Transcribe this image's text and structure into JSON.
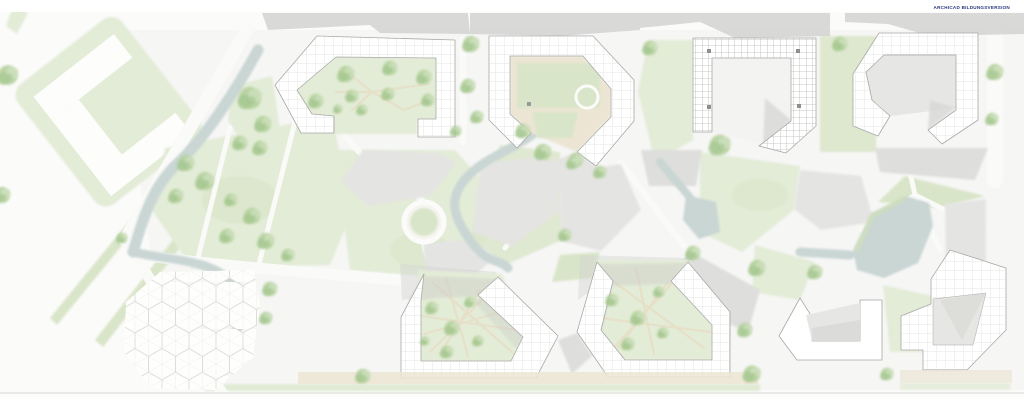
{
  "watermark": {
    "text": "ARCHICAD BILDUNGSVERSION"
  },
  "colors": {
    "bg": "#fbfbfa",
    "site": "#f2f2f0",
    "lawn": "#e3ecd7",
    "lawn2": "#d9e5c8",
    "lawn3": "#cfdfba",
    "tree1": "#b5d19e",
    "tree2": "#a0c489",
    "tree3": "#c8ddb6",
    "plaza": "#e4e4e2",
    "plaza2": "#dededc",
    "shadow": "#d3d3d1",
    "shadow2": "#c9c9c7",
    "water": "#c9d6d4",
    "building": "#ffffff",
    "line": "#a8a8a6",
    "roomline": "#cdcdcb",
    "path": "#e7dfc8",
    "sidewalk": "#ece5d4",
    "hexline": "#d9d9d7",
    "cygray": "#e6e6e4",
    "cygray2": "#d8d8d6",
    "brand": "#27357e"
  }
}
